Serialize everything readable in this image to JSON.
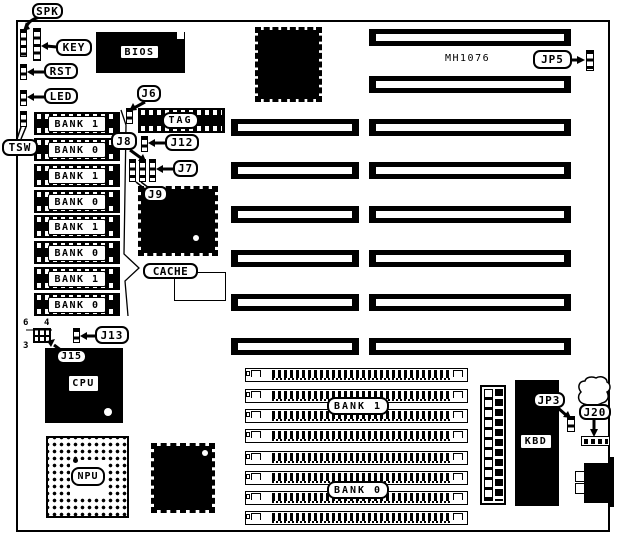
{
  "diagram": {
    "callouts": {
      "spk": "SPK",
      "key": "KEY",
      "rst": "RST",
      "led": "LED",
      "tsw": "TSW",
      "j6": "J6",
      "j8": "J8",
      "j12": "J12",
      "j7": "J7",
      "j9": "J9",
      "cache": "CACHE",
      "j13": "J13",
      "j15": "J15",
      "jp5": "JP5",
      "jp3": "JP3",
      "j20": "J20"
    },
    "chips": {
      "bios": "BIOS",
      "tag": "TAG",
      "cpu": "CPU",
      "npu": "NPU",
      "kbd": "KBD",
      "chipset_part_number": "MH1076"
    },
    "dip_bank_labels": [
      "BANK 1",
      "BANK 0",
      "BANK 1",
      "BANK 0",
      "BANK 1",
      "BANK 0",
      "BANK 1",
      "BANK 0"
    ],
    "simm_bank_labels": {
      "top": "BANK 1",
      "bottom": "BANK 0"
    },
    "jumper_pin_numbers": {
      "top_left": "6",
      "top_right": "4",
      "bottom_left": "3"
    },
    "colors": {
      "ink": "#000000",
      "paper": "#ffffff"
    }
  }
}
